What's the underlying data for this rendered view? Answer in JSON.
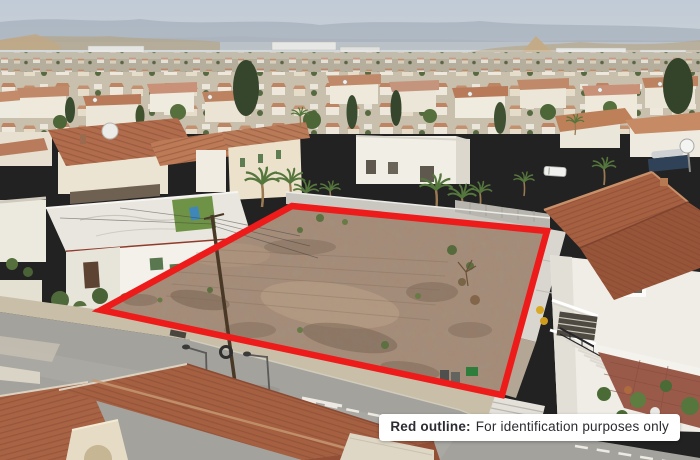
{
  "scene": {
    "type": "aerial-photograph",
    "description": "Drone aerial view of a residential neighbourhood with a vacant corner plot of land outlined in red, surrounded by white houses with terracotta roofs, palm trees, a boundary wall and an asphalt road in the foreground, hazy mountains on the horizon",
    "outline_color": "#ee1b1b",
    "sky_top": "#c0cbd7",
    "sky_bottom": "#d0d3d2",
    "dirt_color": "#a78b76",
    "road_color": "#a4a29d",
    "roof_color": "#a55f41"
  },
  "disclaimer": {
    "bold_label": "Red outline:",
    "text": "For identification purposes only",
    "background": "#ffffff",
    "text_color": "#2b2b31"
  }
}
